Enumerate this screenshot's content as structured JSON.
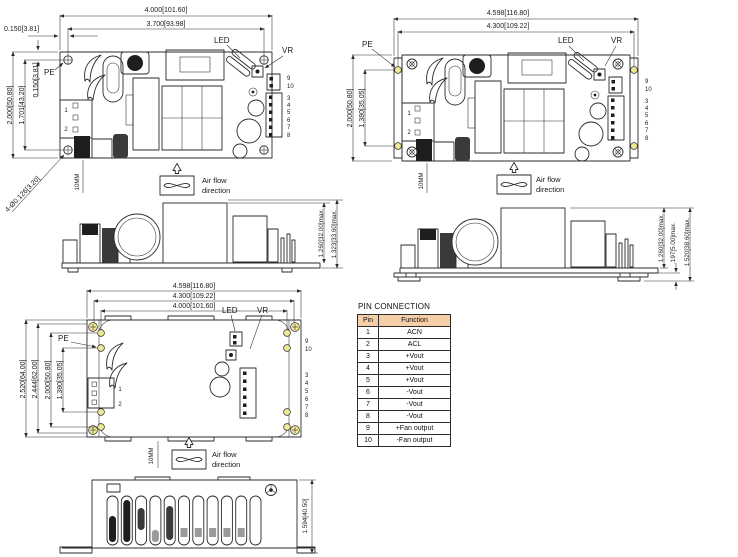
{
  "colors": {
    "line": "#2b2b2b",
    "hole_highlight": "#efe895",
    "table_header_bg": "#f6cfa9"
  },
  "labels": {
    "pe": "PE",
    "led": "LED",
    "vr": "VR",
    "airflow1": "Air flow",
    "airflow2": "direction",
    "clearance": "10MM"
  },
  "pins_left": [
    "1",
    "2"
  ],
  "pins_right": [
    "9",
    "10",
    "3",
    "4",
    "5",
    "6",
    "7",
    "8"
  ],
  "views": {
    "open_frame_top": {
      "w_outer": "4.000[101.60]",
      "w_holes": "3.700[93.98]",
      "x_offset": "0.150[3.81]",
      "h_outer": "2.000[50.80]",
      "h_holes": "1.701[43.20]",
      "y_offset": "0.150[3.81]",
      "holes_note": "4-Ø0.126[3.20]"
    },
    "bracket_top": {
      "w_outer": "4.598[116.80]",
      "w_holes": "4.300[109.22]",
      "h_outer": "2.000[50.80]",
      "h_holes": "1.380[35.05]"
    },
    "open_frame_side": {
      "h_components": "1.260[32.00]max.",
      "h_total": "1.323[33.60]max."
    },
    "bracket_side": {
      "h_components": "1.260[32.00]max.",
      "h_standoff": ".197[5.00]max.",
      "h_total": "1.520[38.60]max."
    },
    "covered_top": {
      "w_outer": "4.598[116.80]",
      "w_holes": "4.300[109.22]",
      "w_inner_holes": "4.000[101.60]",
      "h_outer": "2.520[64.00]",
      "h_flange": "2.444[62.00]",
      "h_holes": "2.000[50.80]",
      "h_inner_holes": "1.380[35.05]"
    },
    "covered_side": {
      "h_total": "1.594[40.50]"
    }
  },
  "pin_table": {
    "title": "PIN CONNECTION",
    "headers": [
      "Pin",
      "Function"
    ],
    "rows": [
      {
        "pin": "1",
        "function": "ACN"
      },
      {
        "pin": "2",
        "function": "ACL"
      },
      {
        "pin": "3",
        "function": "+Vout"
      },
      {
        "pin": "4",
        "function": "+Vout"
      },
      {
        "pin": "5",
        "function": "+Vout"
      },
      {
        "pin": "6",
        "function": "-Vout"
      },
      {
        "pin": "7",
        "function": "-Vout"
      },
      {
        "pin": "8",
        "function": "-Vout"
      },
      {
        "pin": "9",
        "function": "+Fan output"
      },
      {
        "pin": "10",
        "function": "-Fan output"
      }
    ]
  }
}
